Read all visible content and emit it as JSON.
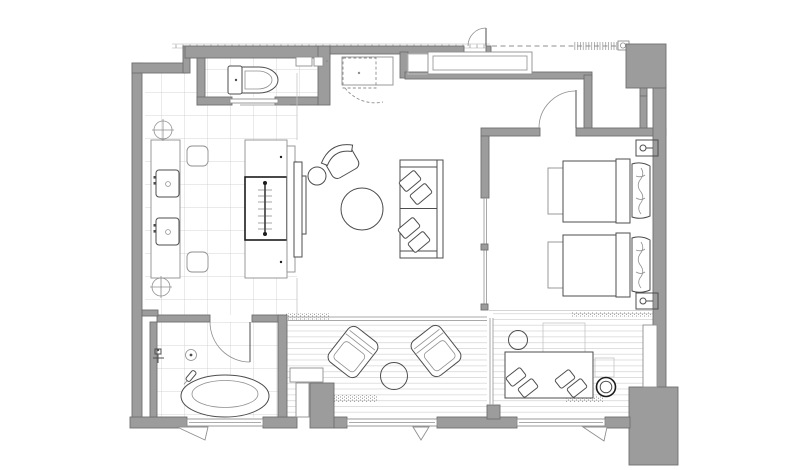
{
  "canvas": {
    "width": "800",
    "height": "470",
    "background": "#ffffff"
  },
  "colors": {
    "wall_fill": "#9c9c9c",
    "wall_stroke": "#6f6f6f",
    "line_strong": "#4d4d4d",
    "line_medium": "#8f8f8f",
    "line_light": "#c6c6c6",
    "deck_line": "#d8d8d8",
    "glass_line": "#a8a8a8",
    "hatch_dot": "#909090",
    "dark_accent": "#1c1c1c",
    "background": "#ffffff"
  },
  "plan": {
    "type": "hotel-suite-floor-plan",
    "text_labels": [],
    "rooms": [
      {
        "id": "toilet-room",
        "items": [
          "toilet",
          "cistern-shelf",
          "sliding-door",
          "tiled-floor"
        ]
      },
      {
        "id": "dressing-area",
        "items": [
          "vanity-counter",
          "sink",
          "sink",
          "ottoman",
          "ottoman",
          "wardrobe-with-hanging-rail",
          "floor-symbol",
          "floor-symbol",
          "tiled-floor"
        ]
      },
      {
        "id": "foyer",
        "items": [
          "entry-door",
          "coat-closet",
          "counter",
          "overhead-cabinet-dashed",
          "dashed-swing"
        ]
      },
      {
        "id": "living-room",
        "items": [
          "tv-panel",
          "armchair",
          "side-table",
          "round-coffee-table",
          "sofa",
          "cushion",
          "cushion",
          "cushion",
          "cushion"
        ]
      },
      {
        "id": "bedroom",
        "items": [
          "twin-bed",
          "twin-bed",
          "bed-bench",
          "bed-bench",
          "wall-lamp",
          "wall-lamp",
          "hinged-door"
        ]
      },
      {
        "id": "window-lounge",
        "items": [
          "daybed",
          "cushion",
          "cushion",
          "cushion",
          "cushion",
          "round-side-table",
          "round-stool",
          "wall-bench",
          "slat-rug",
          "slat-rug",
          "deck-floor"
        ]
      },
      {
        "id": "bathroom",
        "items": [
          "oval-bathtub",
          "floor-drain",
          "shower-mixer",
          "hand-shower",
          "hinged-door",
          "tiled-floor",
          "casement-window"
        ]
      },
      {
        "id": "terrace",
        "items": [
          "lounge-chair",
          "lounge-chair",
          "round-table",
          "deck-floor",
          "sliding-glass-doors",
          "casement-window"
        ]
      }
    ],
    "exterior": [
      "eaves-line",
      "dashed-corridor-line",
      "tick-hatch-band",
      "door-closer-symbol",
      "window-band",
      "window-band",
      "window-band",
      "entry-swing-triangle"
    ]
  }
}
